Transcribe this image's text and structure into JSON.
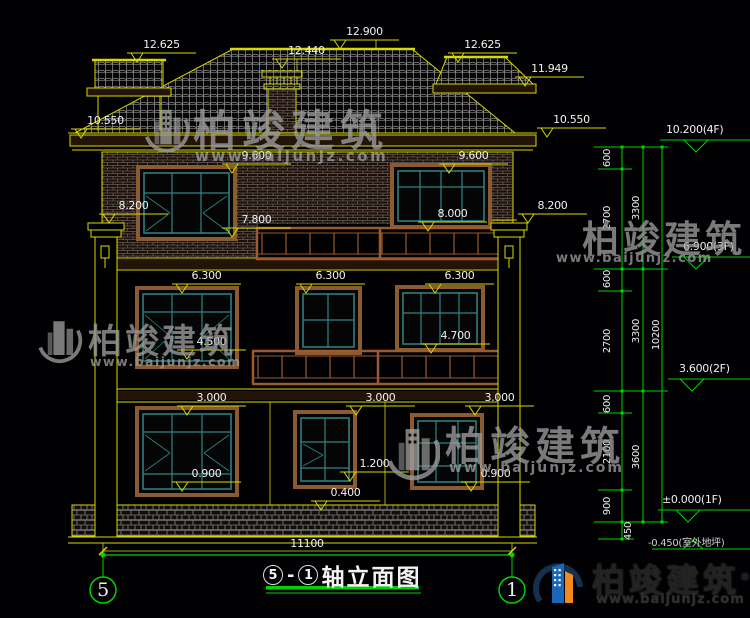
{
  "drawing_title": {
    "axis_start": "5",
    "axis_end": "1",
    "suffix": "轴立面图"
  },
  "axis_bubbles": {
    "left": "5",
    "right": "1"
  },
  "elevation_flags": [
    "12.625",
    "12.900",
    "12.440",
    "12.625",
    "11.949",
    "10.550",
    "10.550",
    "9.600",
    "9.600",
    "8.200",
    "8.200",
    "7.800",
    "8.000",
    "6.300",
    "6.300",
    "6.300",
    "4.500",
    "4.700",
    "3.000",
    "3.000",
    "3.000",
    "1.200",
    "0.900",
    "0.900",
    "0.400"
  ],
  "floor_level_markers": [
    "10.200(4F)",
    "6.900(3F)",
    "3.600(2F)",
    "±0.000(1F)",
    "-0.450(室外地坪)"
  ],
  "dimension_chain": {
    "inner": [
      "600",
      "2700",
      "600",
      "2700",
      "600",
      "2100",
      "900",
      "450"
    ],
    "middle": [
      "3300",
      "3300",
      "3600"
    ],
    "overall": "10200"
  },
  "overall_width_dim": "11100",
  "watermark": {
    "brand": "柏竣建筑",
    "url": "www.baijunjz.com"
  },
  "brand_logo": {
    "name": "柏竣建筑",
    "registered": "®",
    "url": "www.baijunjz.com"
  },
  "colors": {
    "cad_yellow": "#d8d800",
    "cad_green": "#00d400",
    "trim_brown": "#8a5a30",
    "window_teal": "#2e8585",
    "logo_blue": "#1a66b8",
    "logo_orange": "#f08a1e"
  }
}
